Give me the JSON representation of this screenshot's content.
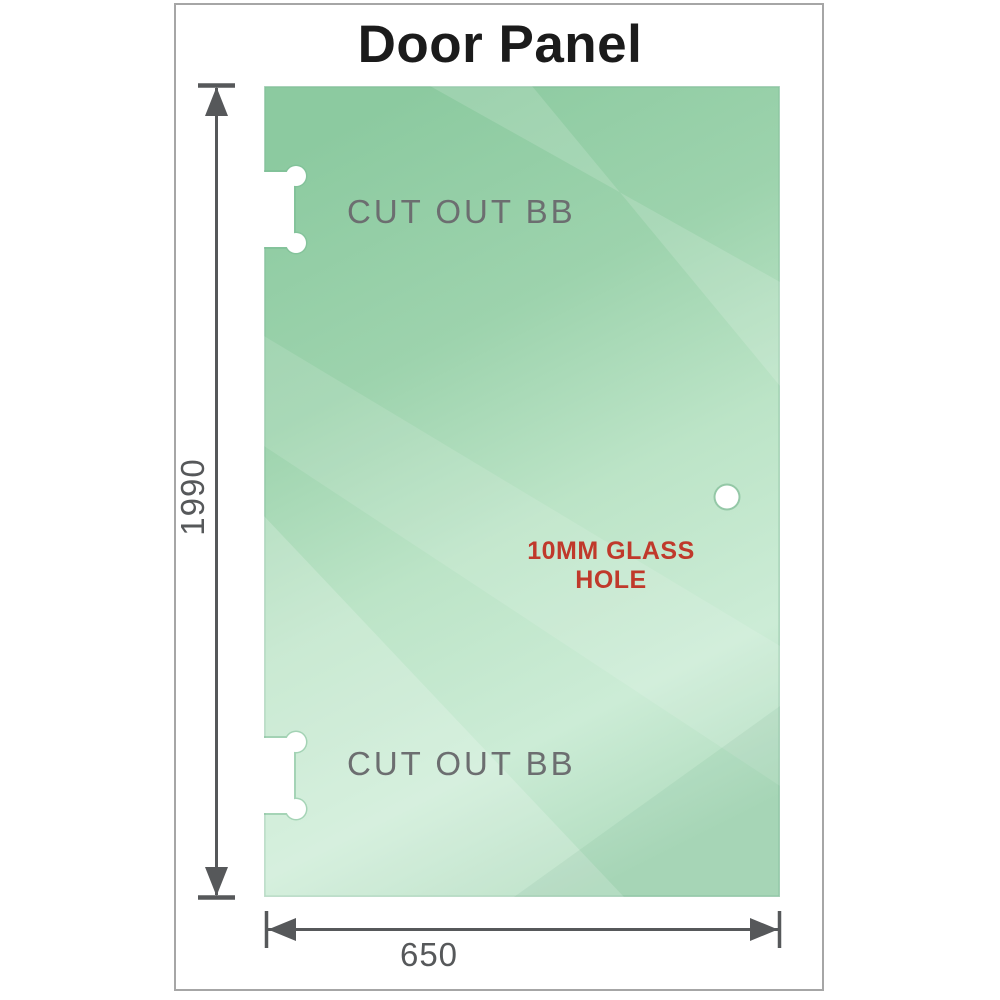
{
  "title": "Door Panel",
  "diagram": {
    "panel": {
      "glass_base_color": "#9bd3ad",
      "glass_light_color": "#ccecd6",
      "edge_color": "#7ab894"
    },
    "cutouts": [
      {
        "label": "CUT OUT BB",
        "position": "top-left"
      },
      {
        "label": "CUT OUT BB",
        "position": "bottom-left"
      }
    ],
    "glass_hole": {
      "label": "10MM GLASS HOLE",
      "label_color": "#c0392b"
    },
    "dimensions": {
      "height_value": "1990",
      "width_value": "650",
      "line_color": "#56585a"
    },
    "annotation_text_color": "#6c6e70",
    "frame_border_color": "#a6a6a6"
  }
}
